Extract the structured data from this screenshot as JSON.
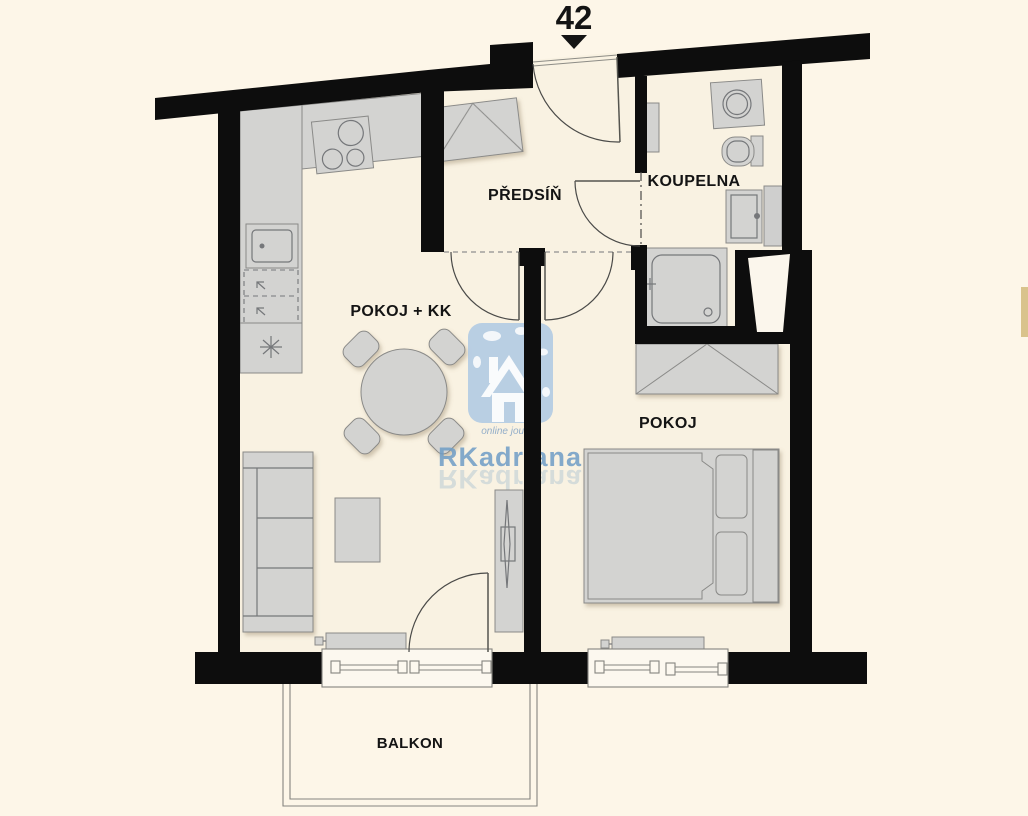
{
  "unit": {
    "number": "42"
  },
  "rooms": {
    "hall": "PŘEDSÍŇ",
    "bathroom": "KOUPELNA",
    "living": "POKOJ + KK",
    "bedroom": "POKOJ",
    "balcony": "BALKON"
  },
  "watermark": {
    "tagline": "online journal",
    "brand": "RKadriana"
  },
  "icons": {
    "entrance_arrow": "triangle-down",
    "fridge_symbol": "asterisk-star",
    "house_logo": "house-icon"
  },
  "colors": {
    "background": "#fdf6e8",
    "floor": "#f9f2e2",
    "wall": "#0d0d0d",
    "furniture": "#d3d3d1",
    "furniture_outline": "#8a8a88",
    "detail": "#75777a",
    "shaft_white": "#fbf6ec",
    "duct_gray": "#cfcfce",
    "watermark_blue": "#a9c6e3",
    "watermark_text": "#6f9dc6",
    "watermark_tagline": "#93aec9",
    "accent_tan": "#d9c38c",
    "label": "#141414"
  }
}
